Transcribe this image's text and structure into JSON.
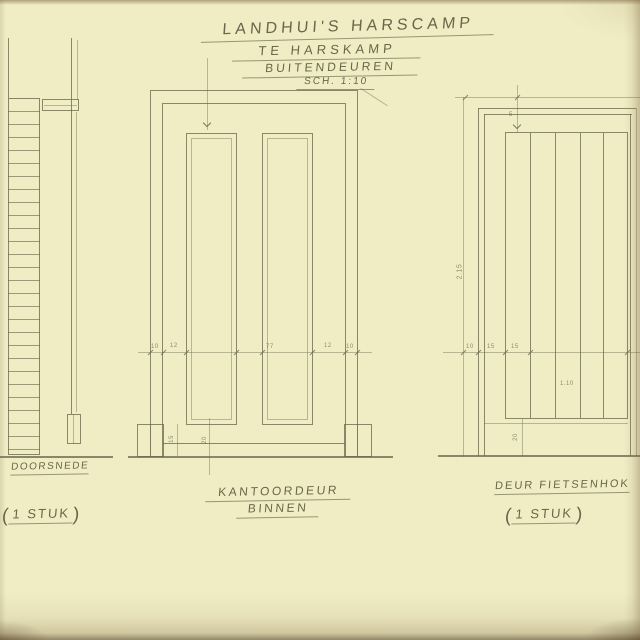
{
  "title_block": {
    "line1": "LANDHUI'S HARSCAMP",
    "line2": "TE HARSKAMP",
    "line3": "BUITENDEUREN",
    "scale": "SCH. 1:10"
  },
  "section_view": {
    "caption": "DOORSNEDE",
    "count": {
      "open": "(",
      "label": "1 STUK",
      "close": ")"
    }
  },
  "office_door_view": {
    "caption_line1": "KANTOORDEUR",
    "caption_line2": "BINNEN",
    "mid_dims": [
      "10",
      "12",
      "77",
      "12",
      "10"
    ],
    "bottom_dims": [
      "15",
      "20"
    ]
  },
  "shed_door_view": {
    "caption": "DEUR FIETSENHOK",
    "count": {
      "open": "(",
      "label": "1 STUK",
      "close": ")"
    },
    "height_dim": "2.15",
    "width_dim": "1.10",
    "top_dim": "5",
    "mid_dims": [
      "10",
      "15",
      "15"
    ],
    "bottom_dim": "20"
  },
  "colors": {
    "paper": "#f0edc5",
    "pencil": "#6d6a4d"
  }
}
